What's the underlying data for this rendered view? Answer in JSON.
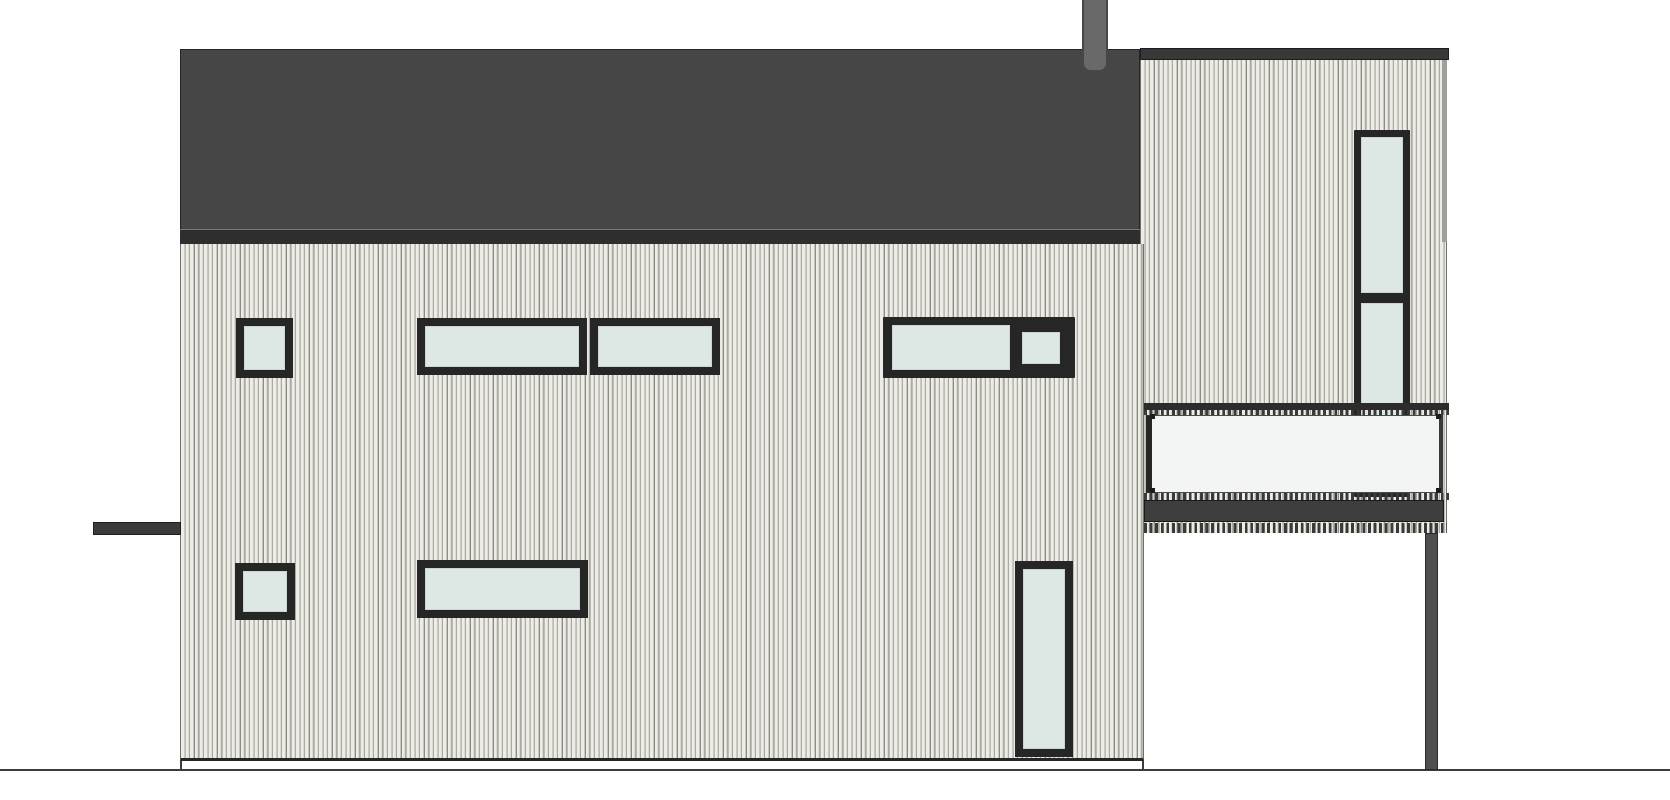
{
  "drawing": {
    "kind": "architectural-elevation",
    "subject": "single-family house side elevation with shed roof, vertical wood siding, chimney, cantilevered tower volume with balcony",
    "canvas": {
      "width": 1670,
      "height": 800
    },
    "palette": {
      "background": "#ffffff",
      "roof": "#464646",
      "roof_fascia": "#2e2e2e",
      "tower_roof_band": "#383838",
      "siding_light": "#edece6",
      "siding_mid": "#c9c8c0",
      "siding_groove": "#8b8a83",
      "window_frame": "#262626",
      "glass": "#dde7e3",
      "balcony_panel": "#f2f5f4",
      "balcony_slab": "#3e3e3e",
      "chimney": "#696969",
      "terrain_line": "#3c3c3c"
    },
    "elements": [
      {
        "name": "terrain-line",
        "cls": "terrain",
        "x": 0,
        "y": 769,
        "w": 1670,
        "h": 2,
        "z": 1
      },
      {
        "name": "tower-siding",
        "cls": "siding tower-siding",
        "x": 1140,
        "y": 60,
        "w": 307,
        "h": 473,
        "z": 2
      },
      {
        "name": "tower-roof-band",
        "cls": "tower-band",
        "x": 1140,
        "y": 48,
        "w": 309,
        "h": 12,
        "z": 2
      },
      {
        "name": "tower-corner-trim",
        "cls": "trim",
        "x": 1442,
        "y": 60,
        "w": 5,
        "h": 182,
        "z": 3
      },
      {
        "name": "main-roof",
        "cls": "roof",
        "x": 180,
        "y": 49,
        "w": 960,
        "h": 181,
        "z": 3
      },
      {
        "name": "roof-fascia",
        "cls": "fascia",
        "x": 180,
        "y": 229,
        "w": 960,
        "h": 16,
        "z": 3
      },
      {
        "name": "chimney",
        "cls": "chimney",
        "x": 1082,
        "y": 0,
        "w": 26,
        "h": 72,
        "z": 4,
        "r": "0 0 9px 9px"
      },
      {
        "name": "main-wall-siding",
        "cls": "siding main-wall",
        "x": 180,
        "y": 244,
        "w": 964,
        "h": 517,
        "z": 3
      },
      {
        "name": "base-connector-left",
        "cls": "connector",
        "x": 180,
        "y": 761,
        "w": 2,
        "h": 9,
        "z": 3
      },
      {
        "name": "base-connector-right",
        "cls": "connector",
        "x": 1142,
        "y": 761,
        "w": 2,
        "h": 9,
        "z": 3
      },
      {
        "name": "entry-canopy",
        "cls": "canopy",
        "x": 93,
        "y": 522,
        "w": 88,
        "h": 13,
        "z": 4
      },
      {
        "name": "window-upper-left-square",
        "cls": "window",
        "x": 236,
        "y": 318,
        "w": 57,
        "h": 60,
        "z": 4,
        "bw": 8
      },
      {
        "name": "window-upper-mid-wide",
        "cls": "window",
        "x": 417,
        "y": 318,
        "w": 170,
        "h": 57,
        "z": 4,
        "bw": 8
      },
      {
        "name": "window-upper-mid-right",
        "cls": "window",
        "x": 590,
        "y": 318,
        "w": 130,
        "h": 57,
        "z": 4,
        "bw": 8
      },
      {
        "name": "window-upper-right-frame",
        "cls": "win-frame",
        "x": 883,
        "y": 317,
        "w": 192,
        "h": 61,
        "z": 4
      },
      {
        "name": "window-upper-right-glass-wide",
        "cls": "glass",
        "x": 892,
        "y": 325,
        "w": 118,
        "h": 45,
        "z": 5
      },
      {
        "name": "window-upper-right-sash-glass",
        "cls": "glass",
        "x": 1022,
        "y": 332,
        "w": 38,
        "h": 32,
        "z": 5
      },
      {
        "name": "window-lower-left-square",
        "cls": "window",
        "x": 235,
        "y": 563,
        "w": 60,
        "h": 57,
        "z": 4,
        "bw": 8
      },
      {
        "name": "window-lower-mid-wide",
        "cls": "window",
        "x": 417,
        "y": 560,
        "w": 171,
        "h": 58,
        "z": 4,
        "bw": 8
      },
      {
        "name": "door-height-window",
        "cls": "window",
        "x": 1015,
        "y": 561,
        "w": 58,
        "h": 196,
        "z": 4,
        "bw": 8
      },
      {
        "name": "tower-window-frame",
        "cls": "win-frame",
        "x": 1354,
        "y": 130,
        "w": 56,
        "h": 367,
        "z": 4
      },
      {
        "name": "tower-window-glass-upper",
        "cls": "glass",
        "x": 1361,
        "y": 137,
        "w": 42,
        "h": 156,
        "z": 5
      },
      {
        "name": "tower-window-glass-lower",
        "cls": "glass",
        "x": 1361,
        "y": 303,
        "w": 42,
        "h": 190,
        "z": 5
      },
      {
        "name": "balcony-rail",
        "cls": "rail",
        "x": 1144,
        "y": 403,
        "w": 305,
        "h": 7,
        "z": 6
      },
      {
        "name": "balcony-balusters-upper",
        "cls": "ticks",
        "x": 1144,
        "y": 410,
        "w": 305,
        "h": 5,
        "z": 6
      },
      {
        "name": "balcony-panel",
        "cls": "panel",
        "x": 1146,
        "y": 415,
        "w": 297,
        "h": 78,
        "z": 6
      },
      {
        "name": "panel-bolt-top-left",
        "cls": "bolt",
        "x": 1150,
        "y": 414,
        "w": 5,
        "h": 5,
        "z": 7
      },
      {
        "name": "panel-bolt-bottom-left",
        "cls": "bolt",
        "x": 1150,
        "y": 488,
        "w": 5,
        "h": 5,
        "z": 7
      },
      {
        "name": "panel-bolt-top-right",
        "cls": "bolt",
        "x": 1436,
        "y": 414,
        "w": 5,
        "h": 5,
        "z": 7
      },
      {
        "name": "panel-bolt-bottom-right",
        "cls": "bolt",
        "x": 1436,
        "y": 488,
        "w": 5,
        "h": 5,
        "z": 7
      },
      {
        "name": "balcony-balusters-mid",
        "cls": "ticks",
        "x": 1144,
        "y": 493,
        "w": 305,
        "h": 7,
        "z": 6
      },
      {
        "name": "balcony-slab",
        "cls": "slab",
        "x": 1144,
        "y": 500,
        "w": 300,
        "h": 22,
        "z": 6
      },
      {
        "name": "balcony-soffit-ticks",
        "cls": "ticks",
        "x": 1144,
        "y": 523,
        "w": 303,
        "h": 10,
        "z": 6
      },
      {
        "name": "balcony-support-post",
        "cls": "post",
        "x": 1425,
        "y": 533,
        "w": 13,
        "h": 237,
        "z": 5
      }
    ]
  }
}
